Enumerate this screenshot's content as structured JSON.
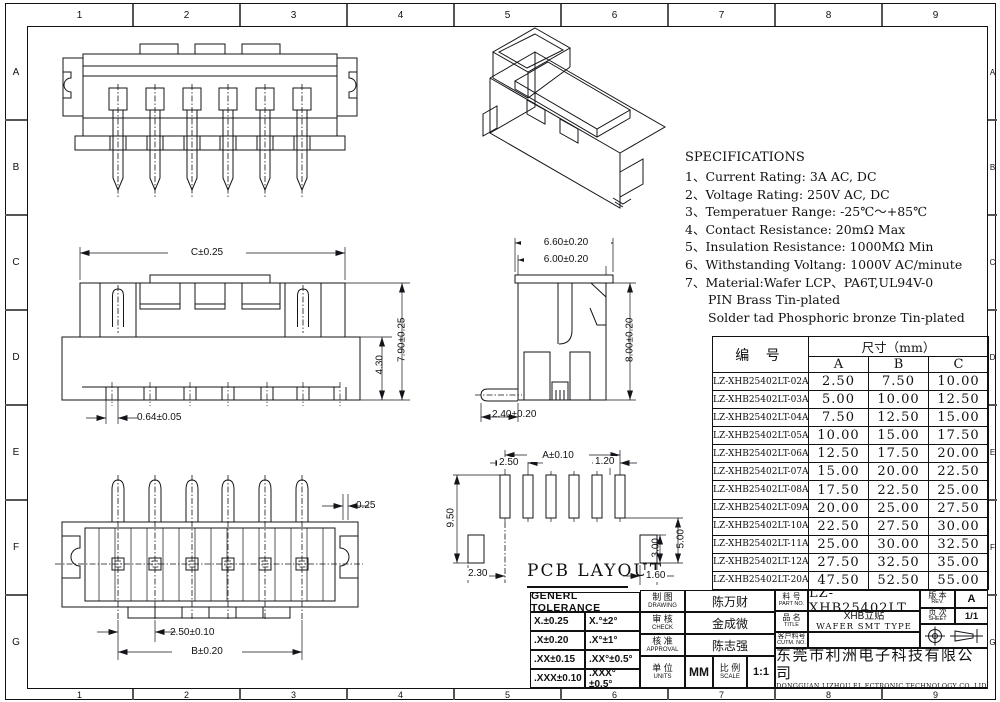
{
  "frame": {
    "cols": [
      "1",
      "2",
      "3",
      "4",
      "5",
      "6",
      "7",
      "8",
      "9"
    ],
    "rows": [
      "A",
      "B",
      "C",
      "D",
      "E",
      "F",
      "G"
    ]
  },
  "specifications": {
    "title": "SPECIFICATIONS",
    "items": [
      "1、Current Rating: 3A AC, DC",
      "2、Voltage Rating: 250V AC, DC",
      "3、Temperatuer Range: -25℃～+85℃",
      "4、Contact Resistance: 20mΩ Max",
      "5、Insulation Resistance: 1000MΩ Min",
      "6、Withstanding Voltang: 1000V AC/minute",
      "7、Material:Wafer LCP、PA6T,UL94V-0",
      "PIN Brass Tin-plated",
      "Solder tad Phosphoric bronze Tin-plated"
    ]
  },
  "size_table": {
    "part_header": "编  号",
    "dim_header": "尺寸（mm）",
    "cols": [
      "A",
      "B",
      "C"
    ],
    "rows": [
      {
        "part": "LZ-XHB25402LT-02A",
        "a": "2.50",
        "b": "7.50",
        "c": "10.00"
      },
      {
        "part": "LZ-XHB25402LT-03A",
        "a": "5.00",
        "b": "10.00",
        "c": "12.50"
      },
      {
        "part": "LZ-XHB25402LT-04A",
        "a": "7.50",
        "b": "12.50",
        "c": "15.00"
      },
      {
        "part": "LZ-XHB25402LT-05A",
        "a": "10.00",
        "b": "15.00",
        "c": "17.50"
      },
      {
        "part": "LZ-XHB25402LT-06A",
        "a": "12.50",
        "b": "17.50",
        "c": "20.00"
      },
      {
        "part": "LZ-XHB25402LT-07A",
        "a": "15.00",
        "b": "20.00",
        "c": "22.50"
      },
      {
        "part": "LZ-XHB25402LT-08A",
        "a": "17.50",
        "b": "22.50",
        "c": "25.00"
      },
      {
        "part": "LZ-XHB25402LT-09A",
        "a": "20.00",
        "b": "25.00",
        "c": "27.50"
      },
      {
        "part": "LZ-XHB25402LT-10A",
        "a": "22.50",
        "b": "27.50",
        "c": "30.00"
      },
      {
        "part": "LZ-XHB25402LT-11A",
        "a": "25.00",
        "b": "30.00",
        "c": "32.50"
      },
      {
        "part": "LZ-XHB25402LT-12A",
        "a": "27.50",
        "b": "32.50",
        "c": "35.00"
      },
      {
        "part": "LZ-XHB25402LT-20A",
        "a": "47.50",
        "b": "52.50",
        "c": "55.00"
      }
    ]
  },
  "dims": {
    "front": {
      "width": "C±0.25",
      "height": "7.90±0.25",
      "step": "4.30",
      "pin": "0.64±0.05"
    },
    "side": {
      "outer": "6.60±0.20",
      "inner": "6.00±0.20",
      "height": "8.00±0.20",
      "tail": "2.40±0.20"
    },
    "bottom": {
      "offset": "0.25",
      "pitch": "2.50±0.10",
      "span": "B±0.20"
    },
    "pcb": {
      "label": "PCB LAYOUT",
      "span": "A±0.10",
      "pitch": "2.50",
      "pad_width": "1.20",
      "height_left": "9.50",
      "height_right": "5.00",
      "pad_height": "3.00",
      "edge_left": "2.30",
      "edge_right": "1.60"
    }
  },
  "title_block": {
    "tolerance": {
      "title": "GENERL TOLERANCE",
      "rows": [
        {
          "lin": "X.±0.25",
          "ang": "X.°±2°"
        },
        {
          "lin": ".X±0.20",
          "ang": ".X°±1°"
        },
        {
          "lin": ".XX±0.15",
          "ang": ".XX°±0.5°"
        },
        {
          "lin": ".XXX±0.10",
          "ang": ".XXX°±0.5°"
        }
      ]
    },
    "drawing": {
      "cn": "制 图",
      "en": "DRAWING",
      "name": "陈万财"
    },
    "check": {
      "cn": "审 核",
      "en": "CHECK",
      "name": "金成微"
    },
    "approval": {
      "cn": "核 准",
      "en": "APPROVAL",
      "name": "陈志强"
    },
    "units": {
      "cn": "单 位",
      "en": "UNITS",
      "value": "MM"
    },
    "scale": {
      "cn": "比 例",
      "en": "SCALE",
      "value": "1:1"
    },
    "part": {
      "cn": "料 号",
      "en": "PART NO.",
      "value": "LZ-XHB25402LT"
    },
    "product": {
      "cn": "品 名",
      "en": "TITLE",
      "value_cn": "XHB立贴",
      "value_en": "WAFER SMT TYPE"
    },
    "customer": {
      "cn": "客户料号",
      "en": "CUTM. NO.",
      "value": ""
    },
    "rev": {
      "cn": "版 本",
      "en": "REV.",
      "value": "A"
    },
    "sheet": {
      "cn": "页 次",
      "en": "SHEET",
      "value": "1/1"
    },
    "company": {
      "cn": "东莞市利洲电子科技有限公司",
      "en": "DONGGUAN LIZHOU EL ECTRONIC TECHNOLOGY CO.,LID"
    }
  }
}
